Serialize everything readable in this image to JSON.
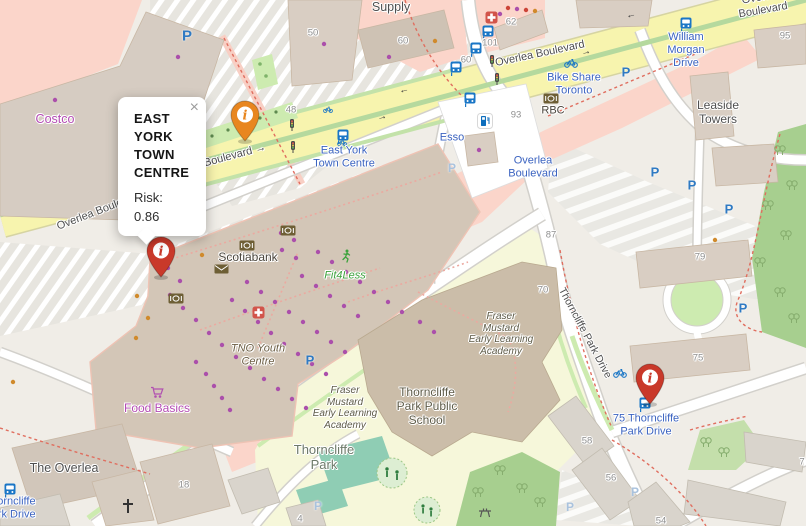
{
  "popup": {
    "title": "EAST YORK TOWN CENTRE",
    "risk_label": "Risk:",
    "risk_value": "0.86",
    "close_glyph": "×"
  },
  "markers": {
    "glyph": "i",
    "items": [
      {
        "name": "east-york-town-centre",
        "color": "#e8861f"
      },
      {
        "name": "east-york-town-centre-west",
        "color": "#c9392a"
      },
      {
        "name": "75-thorncliffe-park-drive",
        "color": "#c9392a"
      }
    ]
  },
  "glyphs": {
    "parking": "P",
    "arrow_left": "←",
    "arrow_right": "→"
  },
  "labels": {
    "streets": [
      {
        "text": "Overlea Boulevard"
      },
      {
        "text": "Overlea Boulevard →"
      },
      {
        "text": "Overlea Boulevard"
      },
      {
        "text": "Overlea Boulevard"
      },
      {
        "text": "Thorncliffe Park Drive"
      }
    ],
    "transit": [
      {
        "text": "East York\nTown Centre"
      },
      {
        "text": "Overlea\nBoulevard"
      },
      {
        "text": "Bike Share\nToronto"
      },
      {
        "text": "William\nMorgan\nDrive"
      },
      {
        "text": "75 Thorncliffe\nPark Drive"
      },
      {
        "text": "Thorncliffe\nPark Drive"
      },
      {
        "text": "Esso"
      }
    ],
    "pois": [
      {
        "text": "Supply"
      },
      {
        "text": "Costco"
      },
      {
        "text": "Scotiabank"
      },
      {
        "text": "Fit4Less"
      },
      {
        "text": "TNO Youth\nCentre"
      },
      {
        "text": "Food Basics"
      },
      {
        "text": "The Overlea"
      },
      {
        "text": "Fraser\nMustard\nEarly Learning\nAcademy"
      },
      {
        "text": "Fraser\nMustard\nEarly Learning\nAcademy"
      },
      {
        "text": "Thorncliffe\nPark Public\nSchool"
      },
      {
        "text": "Thorncliffe\nPark"
      },
      {
        "text": "Leaside\nTowers"
      },
      {
        "text": "RBC"
      }
    ],
    "house_numbers": [
      {
        "text": "50"
      },
      {
        "text": "60"
      },
      {
        "text": "62"
      },
      {
        "text": "101"
      },
      {
        "text": "60"
      },
      {
        "text": "48"
      },
      {
        "text": "93"
      },
      {
        "text": "87"
      },
      {
        "text": "95"
      },
      {
        "text": "79"
      },
      {
        "text": "70"
      },
      {
        "text": "75"
      },
      {
        "text": "58"
      },
      {
        "text": "56"
      },
      {
        "text": "54"
      },
      {
        "text": "18"
      },
      {
        "text": "4"
      },
      {
        "text": "7"
      }
    ]
  }
}
